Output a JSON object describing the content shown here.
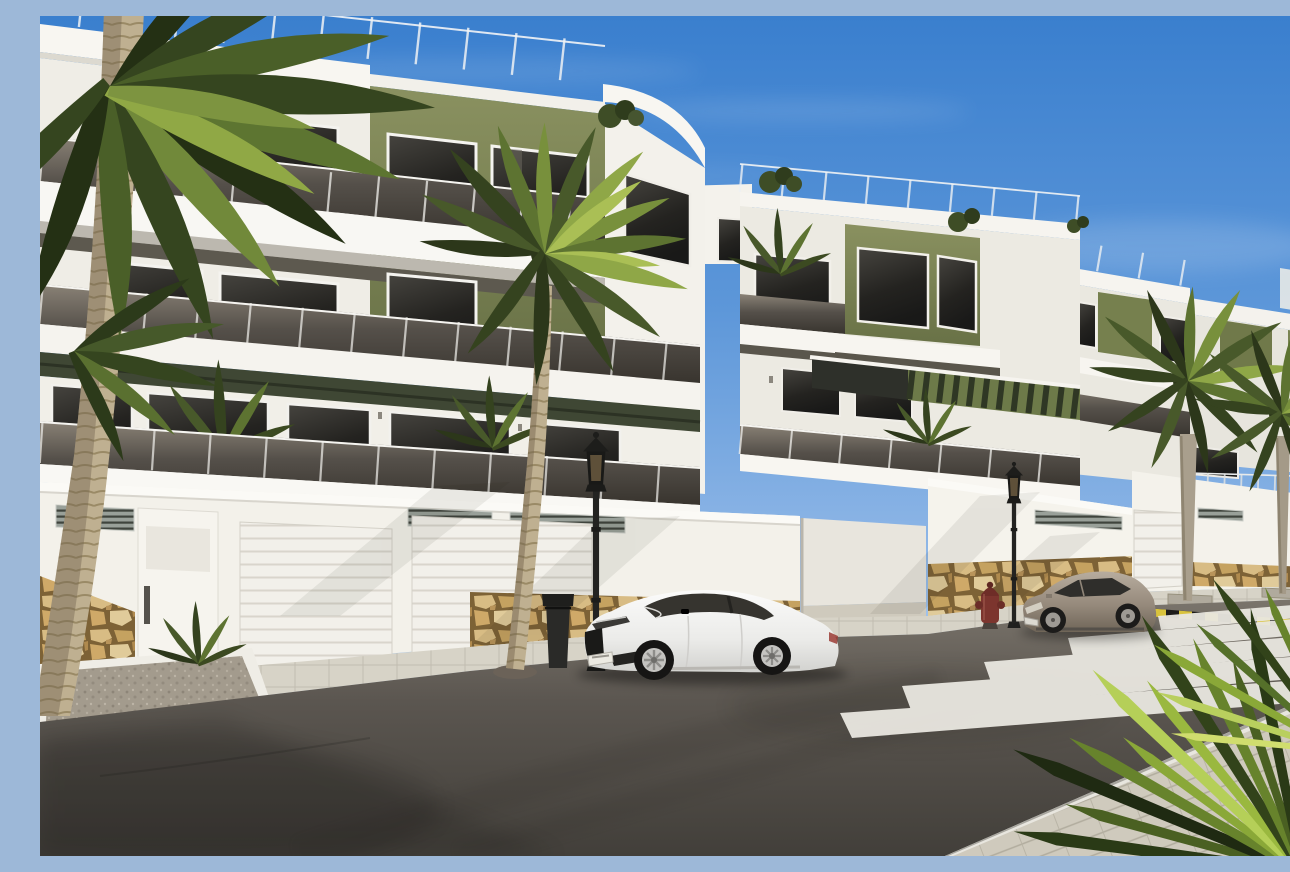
{
  "meta": {
    "title": "Street view render of a new-build white apartment complex with olive-green accents, palm trees and parked cars",
    "image_type": "photorealistic architectural exterior render",
    "time_of_day": "sunny daytime, clear blue sky"
  },
  "palette": {
    "sky_top": "#3a7fce",
    "sky_horizon": "#d9e7f6",
    "facade_white": "#f4f2ec",
    "facade_shadow": "#dedbd2",
    "accent_olive": "#7b8455",
    "pergola_dark_olive": "#3f4734",
    "glass_tint_dark": "#3a362f",
    "window_dark": "#232220",
    "stone_tan": "#c9a467",
    "asphalt": "#55514b",
    "sidewalk_paver": "#d6d2c6",
    "curb_white": "#eceae3",
    "palm_green_dark": "#2c371a",
    "palm_green_light": "#aabf55",
    "palm_trunk_tan": "#bfb091",
    "lamp_black": "#222220",
    "car_white": "#f2f2f1",
    "car_gray_beige": "#9a8d80",
    "hydrant_red": "#7c352e",
    "marking_yellow": "#d9c33c",
    "crosswalk_white": "#e9e7e0"
  },
  "scene": {
    "buildings": {
      "style": "modern three-storey apartments, white render with olive-green feature panels",
      "features": [
        "rooftop glass railings",
        "tinted glass balcony balustrades",
        "white balcony slabs",
        "dark tinted windows and sliding doors",
        "olive slatted pergolas over terraces",
        "white perimeter street wall",
        "natural stone clad wall bases",
        "louvre vent grilles",
        "white sectional garage doors",
        "white pedestrian door with dark handle",
        "rooftop and terrace plants"
      ]
    },
    "street": {
      "elements": [
        "asphalt road",
        "paved sidewalk with planter bed",
        "paver-stone corner sidewalk",
        "zebra crosswalk of five white stripes",
        "yellow and black striped kerb marking",
        "driveway opening between wall sections"
      ]
    },
    "vehicles": [
      {
        "type": "white two-door coupe",
        "state": "parked at kerb facing left",
        "plate": "unreadable"
      },
      {
        "type": "beige-gray two-door coupe",
        "state": "parked further along the kerb facing left",
        "plate": "unreadable"
      }
    ],
    "furniture": [
      {
        "item": "classic black lantern street lamp",
        "count": 3
      },
      {
        "item": "black litter bin"
      },
      {
        "item": "dark red fire hydrant"
      }
    ],
    "vegetation": [
      {
        "item": "tall palm tree, foreground far left"
      },
      {
        "item": "tall palm tree, center foreground in front of garages"
      },
      {
        "item": "two bushy palms by the right-hand buildings"
      },
      {
        "item": "spiky fan palm, bottom right foreground"
      },
      {
        "item": "small terrace and rooftop palms and shrubs"
      }
    ]
  }
}
